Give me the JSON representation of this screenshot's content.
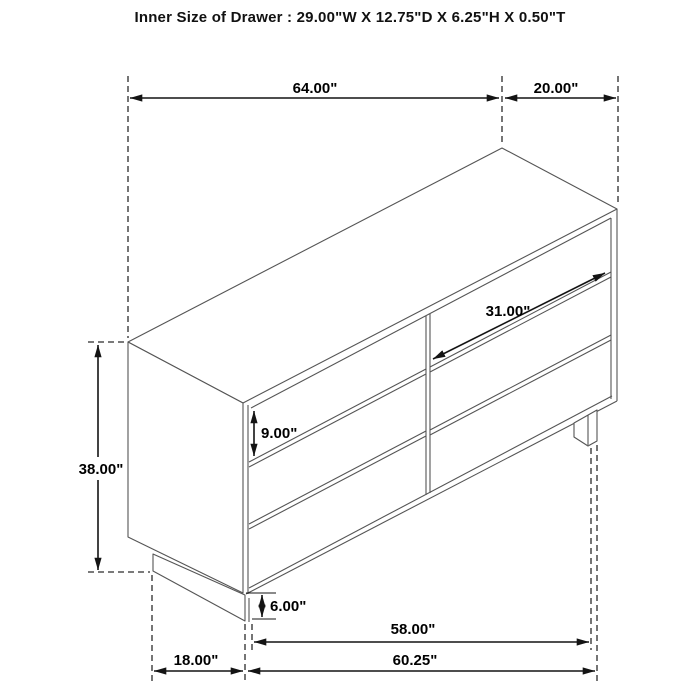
{
  "title": "Inner Size of Drawer : 29.00\"W X 12.75\"D X 6.25\"H X 0.50\"T",
  "drawer_inner_size": {
    "width": "29.00\"W",
    "depth": "12.75\"D",
    "height": "6.25\"H",
    "thickness": "0.50\"T"
  },
  "dimensions": {
    "top_width": "64.00\"",
    "top_depth": "20.00\"",
    "drawer_width": "31.00\"",
    "drawer_front_height": "9.00\"",
    "overall_height": "38.00\"",
    "base_height": "6.00\"",
    "bottom_inner_width": "58.00\"",
    "bottom_overall_width": "60.25\"",
    "bottom_side_depth": "18.00\""
  },
  "figure": {
    "subject": "six-drawer-dresser-isometric-line-drawing",
    "drawer_columns": 2,
    "drawer_rows": 3
  },
  "colors": {
    "background": "#ffffff",
    "furniture_line": "#555555",
    "dimension_line": "#141414",
    "text": "#000000"
  }
}
